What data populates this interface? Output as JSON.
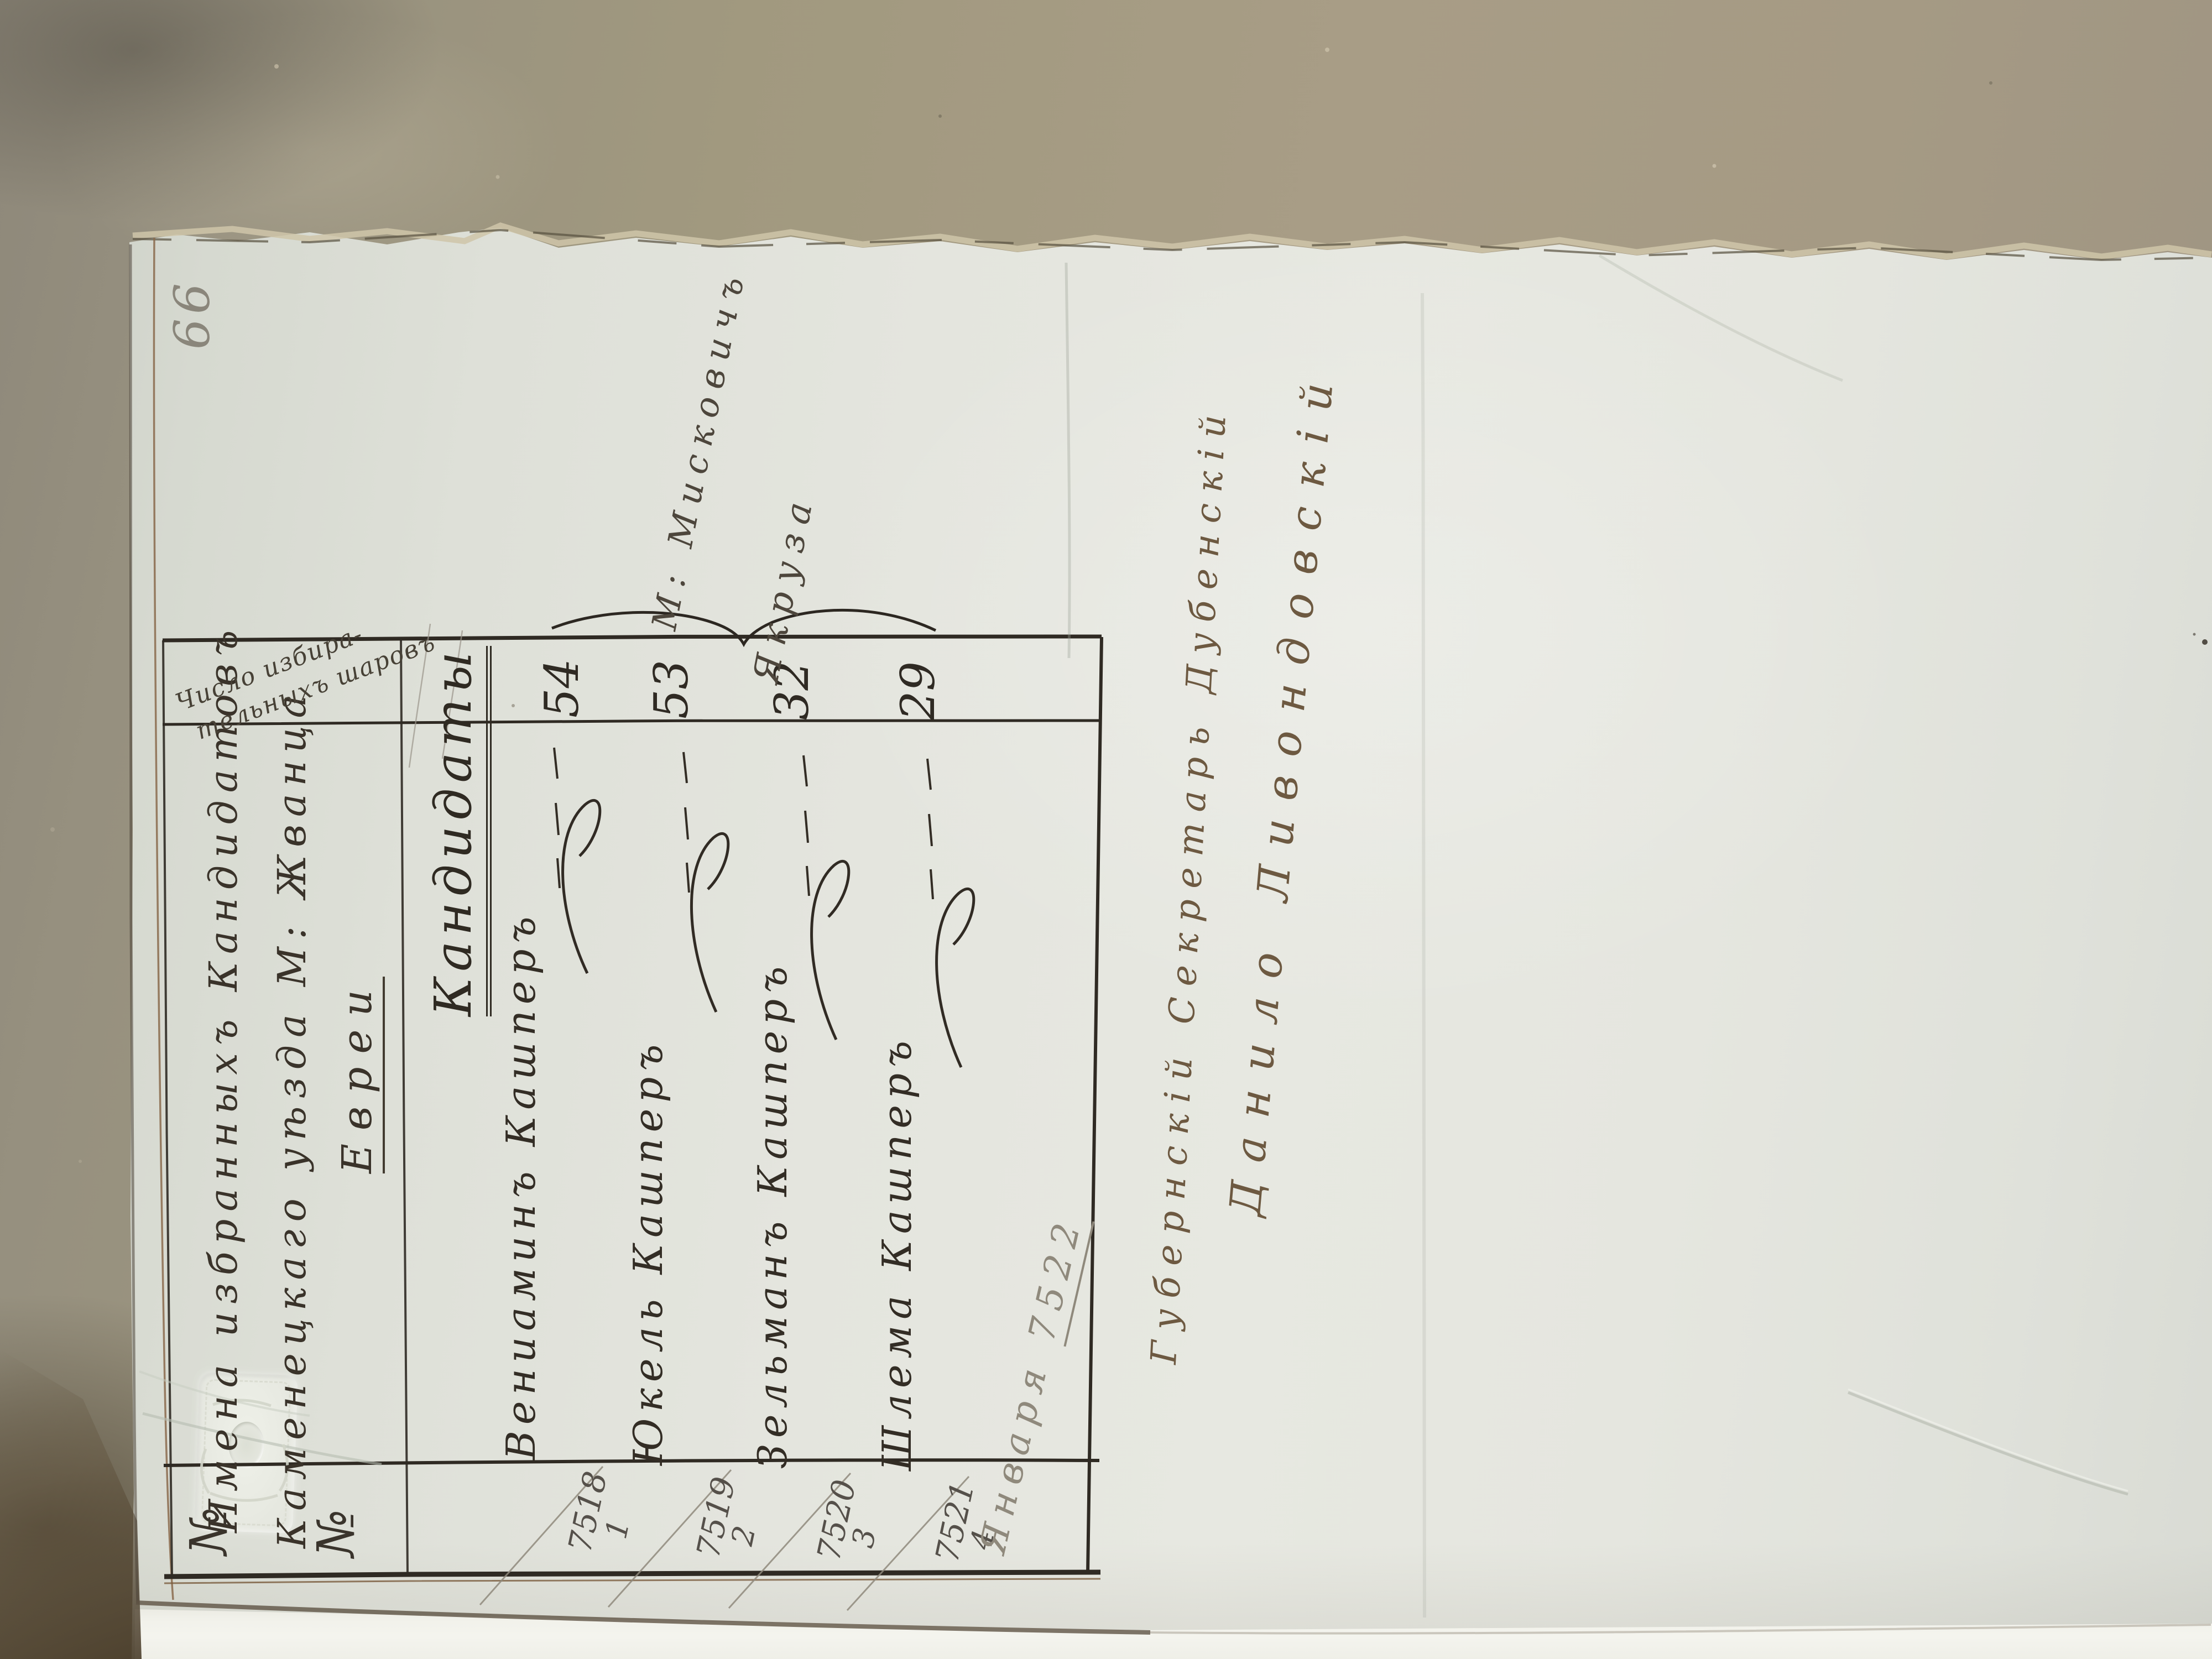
{
  "document": {
    "page_number": "66",
    "table": {
      "row_header": {
        "line1": "Имена избранныхъ Кандидатовъ",
        "line2": "Каменецкаго уѣзда М: Жванца",
        "line3": "Евреи"
      },
      "votes_col_header": {
        "line1": "Число избира-",
        "line2": "тельныхъ шаровъ"
      },
      "number_col_header": {
        "first": "№",
        "second": "№"
      },
      "title": "Кандидаты",
      "entries": [
        {
          "registry_no": "7518",
          "order": "1",
          "name": "Вениаминъ Кашперъ",
          "votes": "54"
        },
        {
          "registry_no": "7519",
          "order": "2",
          "name": "Юкель Кашперъ",
          "votes": "53"
        },
        {
          "registry_no": "7520",
          "order": "3",
          "name": "Зельманъ Кашперъ",
          "votes": "32"
        },
        {
          "registry_no": "7521",
          "order": "4",
          "name": "Шлема Кашперъ",
          "votes": "29"
        }
      ]
    },
    "margin_annotation": {
      "line1": "М: Мисковичъ",
      "line2": "Якруза"
    },
    "footnote": {
      "word": "Января",
      "number": "7522"
    },
    "signatures": {
      "line1": "Губернскій Секретарь Дубенскій",
      "line2": "Данило Ливондовскій"
    }
  },
  "colors": {
    "ink": "#332d25",
    "signature_ink": "#6d5941",
    "pencil": "#8f897c",
    "paper": "#e2e4dc",
    "cardboard": "#a0957f"
  }
}
